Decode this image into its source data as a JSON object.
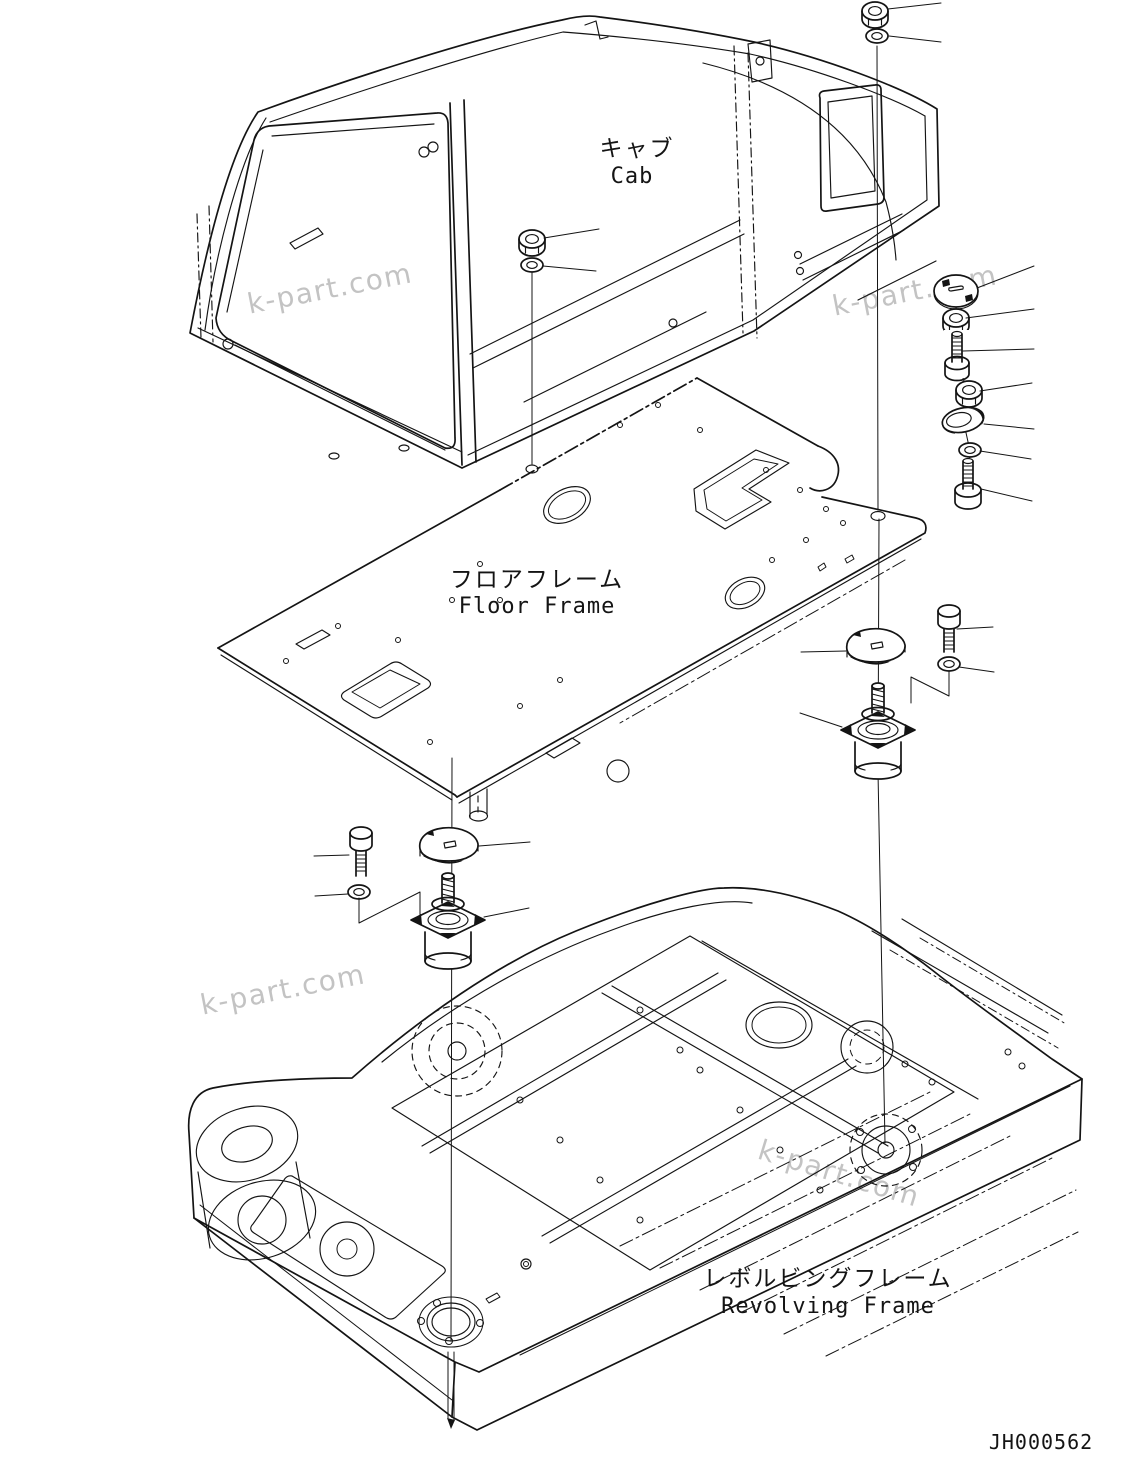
{
  "page": {
    "background": "#ffffff",
    "ink_color": "#141414",
    "watermark_color": "#b9b9b9",
    "drawing_number": "JH000562",
    "watermark_text": "k-part.com",
    "labels": {
      "cab": {
        "jp": "キャブ",
        "en": "Cab"
      },
      "floor_frame": {
        "jp": "フロアフレーム",
        "en": "Floor Frame"
      },
      "revolving_frame": {
        "jp": "レボルビングフレーム",
        "en": "Revolving Frame"
      }
    },
    "part_glyphs": [
      "hex-nut",
      "flat-washer",
      "hex-bolt",
      "stud-bolt",
      "mount-cover-plate",
      "cam-washer-plate",
      "mount-top-disc",
      "cab-rubber-mount"
    ]
  }
}
